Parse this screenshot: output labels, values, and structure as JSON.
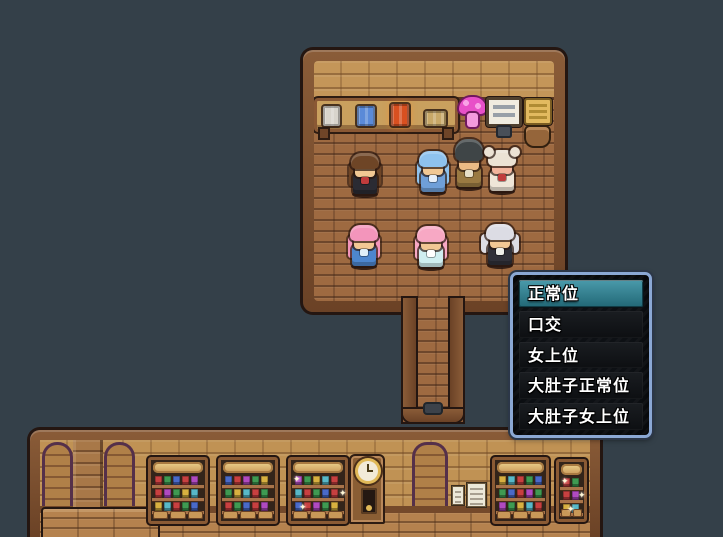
{
  "scene": {
    "background_color": "#344049",
    "wood_color": "#6b4226",
    "wall_brick_color": "#c49659",
    "floor_brick_color": "#9e6a41",
    "face_color": "#f2c894"
  },
  "menu": {
    "border_color": "#8ba8d4",
    "background_color": "#0d1014",
    "highlight_color": "#2e8296",
    "items": [
      {
        "label": "正常位",
        "selected": true
      },
      {
        "label": "口交",
        "selected": false
      },
      {
        "label": "女上位",
        "selected": false
      },
      {
        "label": "大肚子正常位",
        "selected": false
      },
      {
        "label": "大肚子女上位",
        "selected": false
      }
    ]
  },
  "top_room": {
    "shelf_items": [
      {
        "name": "white-crate-icon",
        "color": "#d8d4cc",
        "x": 6,
        "w": 17,
        "h": 20,
        "glow": false
      },
      {
        "name": "blue-crate-icon",
        "color": "#5a8ad8",
        "x": 40,
        "w": 18,
        "h": 20,
        "glow": false
      },
      {
        "name": "red-crate-icon",
        "color": "#d85020",
        "x": 74,
        "w": 18,
        "h": 22,
        "glow": true
      },
      {
        "name": "basket-icon",
        "color": "#c8a868",
        "x": 108,
        "w": 21,
        "h": 15,
        "glow": false
      }
    ],
    "characters": [
      {
        "name": "npc-brown-hair-girl",
        "x": 347,
        "y": 140,
        "hair": "#6e4526",
        "hairStyle": "long",
        "dress": "#2b2b33",
        "accent": "#c03c3c",
        "face": "#f2c894"
      },
      {
        "name": "npc-blue-hair-girl",
        "x": 415,
        "y": 138,
        "hair": "#8ec2ee",
        "hairStyle": "long",
        "dress": "#6f9fd8",
        "accent": "#e8f0fa",
        "face": "#f2c894"
      },
      {
        "name": "npc-dark-pompadour-man",
        "x": 451,
        "y": 133,
        "hair": "#3f4547",
        "hairStyle": "spiky",
        "dress": "#9a7a42",
        "accent": "#e8e0c8",
        "face": "#ecba84"
      },
      {
        "name": "npc-pig-face-maid",
        "x": 484,
        "y": 137,
        "hair": "#ece2d4",
        "hairStyle": "buns",
        "dress": "#efe6d8",
        "accent": "#c03c3c",
        "face": "#f2b49c"
      },
      {
        "name": "npc-pink-hair-girl-blue",
        "x": 346,
        "y": 212,
        "hair": "#f395bb",
        "hairStyle": "long",
        "dress": "#4d86ce",
        "accent": "#dfeef8",
        "face": "#f2c894"
      },
      {
        "name": "npc-pink-hair-girl-teal",
        "x": 413,
        "y": 213,
        "hair": "#f7a8c4",
        "hairStyle": "long",
        "dress": "#cfeef0",
        "accent": "#ffffff",
        "face": "#f2c894"
      },
      {
        "name": "npc-silver-twintail-maid",
        "x": 482,
        "y": 211,
        "hair": "#dcdce4",
        "hairStyle": "twintail",
        "dress": "#303038",
        "accent": "#efefe8",
        "face": "#f2c894"
      }
    ]
  },
  "bottom_room": {
    "shelves": [
      {
        "name": "bookshelf-1",
        "x": 108,
        "y": 17,
        "w": 60,
        "h": 67,
        "drawers": 3,
        "sparkle": false
      },
      {
        "name": "bookshelf-2",
        "x": 178,
        "y": 17,
        "w": 60,
        "h": 67,
        "drawers": 3,
        "sparkle": false
      },
      {
        "name": "bookshelf-3",
        "x": 248,
        "y": 17,
        "w": 60,
        "h": 67,
        "drawers": 3,
        "sparkle": true
      },
      {
        "name": "bookshelf-4",
        "x": 452,
        "y": 17,
        "w": 57,
        "h": 67,
        "drawers": 3,
        "sparkle": false
      },
      {
        "name": "bookshelf-small",
        "x": 516,
        "y": 19,
        "w": 31,
        "h": 63,
        "drawers": 2,
        "sparkle": true
      }
    ],
    "item_colors": [
      "#c84040",
      "#3f9a52",
      "#4a6ac8",
      "#c84040",
      "#b04ac0",
      "#3f9a52",
      "#d8b040",
      "#58b8c8"
    ],
    "clock": {
      "face": "#f2ead8",
      "ring": "#e0b858",
      "body": "#8a5e34"
    },
    "notes_count": 2
  }
}
